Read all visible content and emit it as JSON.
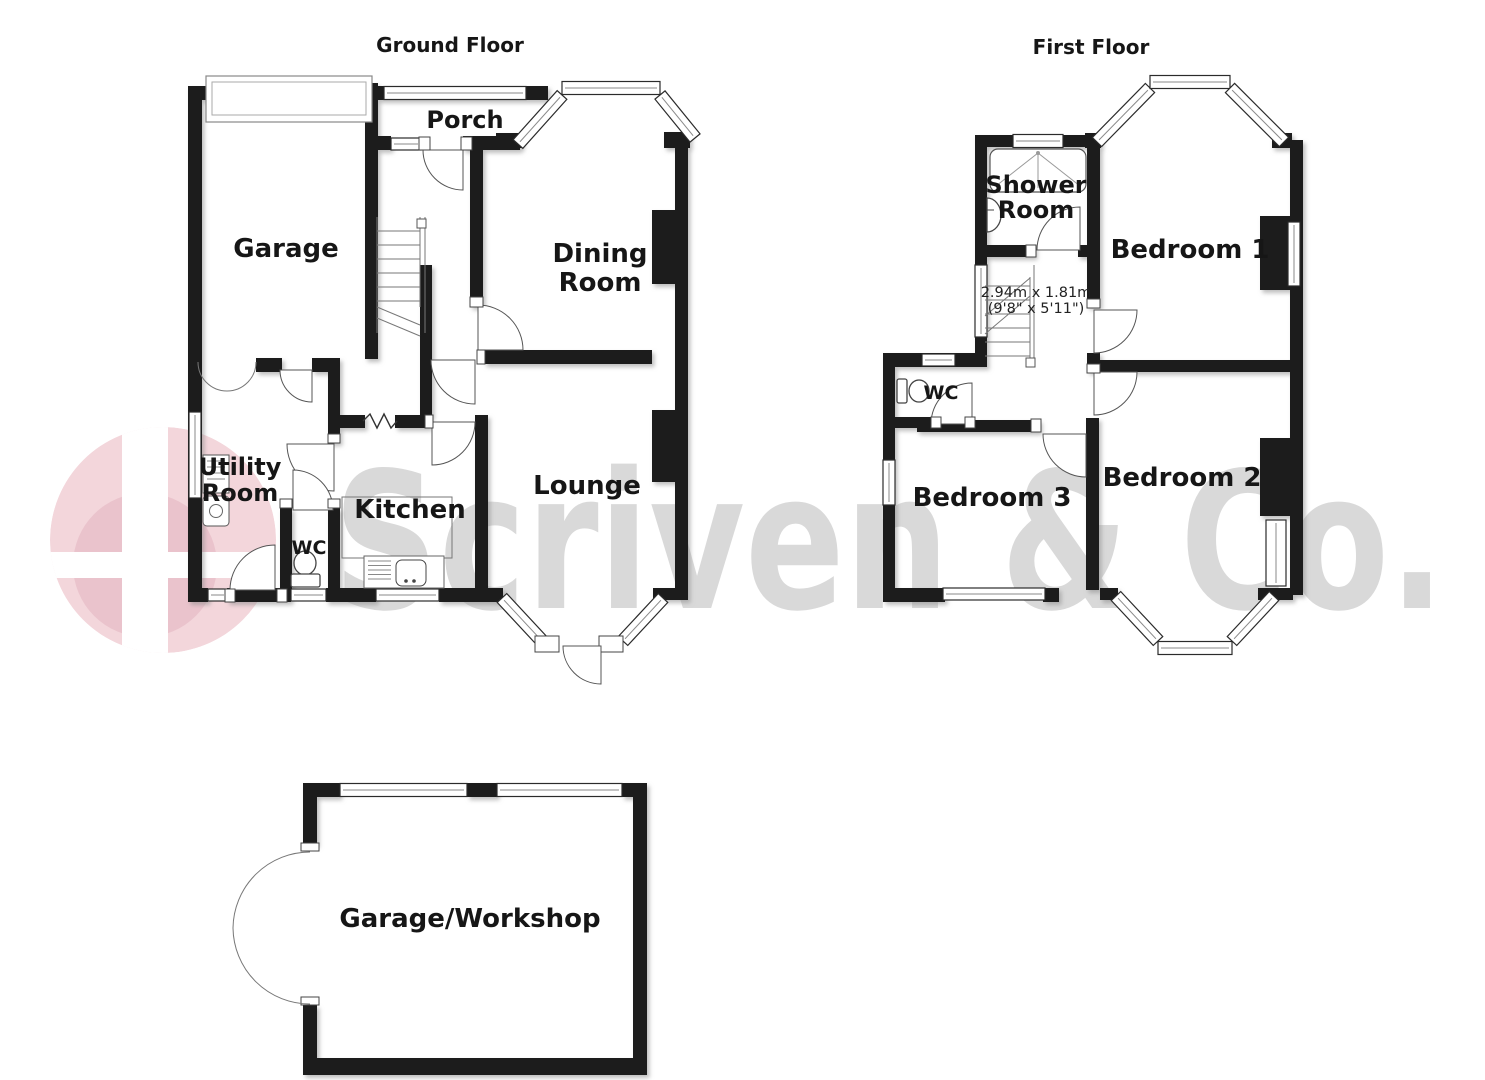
{
  "watermark": {
    "text": "Scriven & Co.",
    "text_color": "#d9d9d9",
    "logo_pink": "#f3d6db",
    "logo_dark_pink": "#eac3cc",
    "logo_cross_color": "#ffffff"
  },
  "plan": {
    "wall_color": "#1c1c1c",
    "line_color": "#666666",
    "label_color": "#161616"
  },
  "floors": [
    {
      "id": "ground",
      "title": "Ground Floor",
      "rooms": [
        {
          "id": "garage",
          "label_lines": [
            "Garage"
          ]
        },
        {
          "id": "porch",
          "label_lines": [
            "Porch"
          ]
        },
        {
          "id": "dining",
          "label_lines": [
            "Dining",
            "Room"
          ]
        },
        {
          "id": "lounge",
          "label_lines": [
            "Lounge"
          ]
        },
        {
          "id": "kitchen",
          "label_lines": [
            "Kitchen"
          ]
        },
        {
          "id": "utility",
          "label_lines": [
            "Utility",
            "Room"
          ]
        },
        {
          "id": "wc-ground",
          "label_lines": [
            "WC"
          ]
        }
      ]
    },
    {
      "id": "first",
      "title": "First Floor",
      "rooms": [
        {
          "id": "shower",
          "label_lines": [
            "Shower",
            "Room"
          ]
        },
        {
          "id": "bedroom1",
          "label_lines": [
            "Bedroom 1"
          ]
        },
        {
          "id": "bedroom2",
          "label_lines": [
            "Bedroom 2"
          ]
        },
        {
          "id": "bedroom3",
          "label_lines": [
            "Bedroom 3"
          ]
        },
        {
          "id": "wc-first",
          "label_lines": [
            "WC"
          ]
        },
        {
          "id": "landing",
          "label_lines": [],
          "dimension_lines": [
            "2.94m x 1.81m",
            "(9'8\" x 5'11\")"
          ]
        }
      ]
    },
    {
      "id": "outbuilding",
      "rooms": [
        {
          "id": "garage-workshop",
          "label_lines": [
            "Garage/Workshop"
          ]
        }
      ]
    }
  ]
}
